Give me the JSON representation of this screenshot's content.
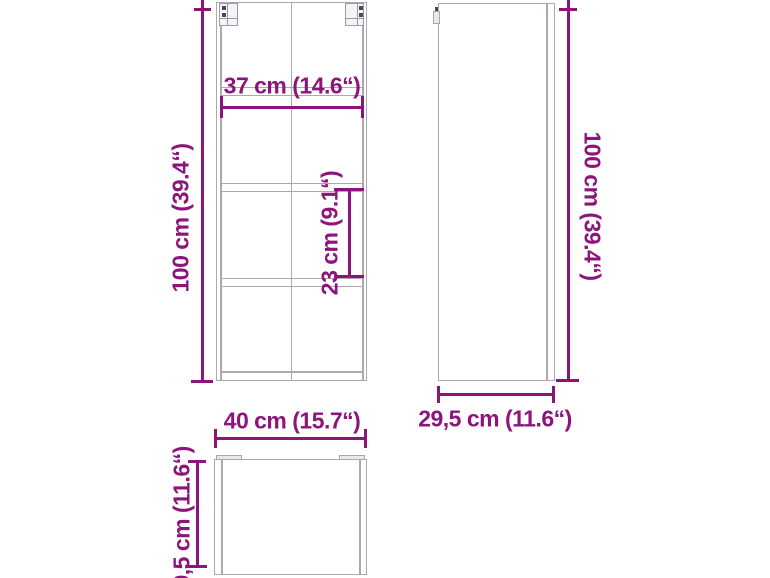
{
  "colors": {
    "dimension": "#8c147a",
    "outline": "#a9a9af"
  },
  "front_view": {
    "height_label": "100 cm (39.4“)",
    "width_label": "37 cm (14.6“)",
    "compartment_label": "23 cm (9.1“)"
  },
  "side_view": {
    "height_label": "100 cm (39.4“)",
    "depth_label": "29,5 cm (11.6“)"
  },
  "top_view": {
    "width_label": "40 cm (15.7“)",
    "depth_label": "29,5 cm (11.6“)"
  }
}
